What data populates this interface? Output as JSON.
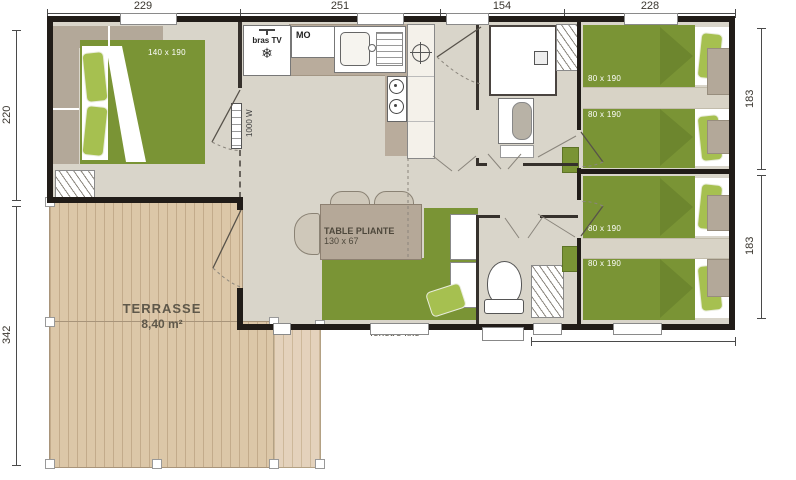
{
  "dims": {
    "top": [
      "229",
      "251",
      "154",
      "228"
    ],
    "left": [
      "220",
      "342"
    ],
    "right": [
      "183",
      "183"
    ],
    "bottom": [
      "253"
    ]
  },
  "rooms": {
    "master_bedroom": {
      "bed_label": "140 x 190"
    },
    "kitchen": {
      "tv_label": "bras TV",
      "microwave_label": "MO",
      "heater_label": "1000 W"
    },
    "living": {
      "table_label": "TABLE PLIANTE",
      "table_size": "130 x 67"
    },
    "bedroom_top_right": {
      "bed1_label": "80 x 190",
      "bed2_label": "80 x 190"
    },
    "bedroom_bottom_right": {
      "bed1_label": "80 x 190",
      "bed2_label": "80 x 190"
    },
    "terrace": {
      "name": "TERRASSE",
      "area": "8,40 m²"
    },
    "window_label": "fenêtre fixe"
  },
  "icons": {
    "snowflake": "❄"
  },
  "colors": {
    "wall": "#211c18",
    "floor": "#d9d5ca",
    "bed_green": "#7a9435",
    "pillow_green": "#a6c050",
    "counter": "#b9ac9c",
    "furniture_gray": "#b3a899",
    "deck_wood": "#dcc7a8",
    "deck_wood_light": "#e4d2bc"
  }
}
